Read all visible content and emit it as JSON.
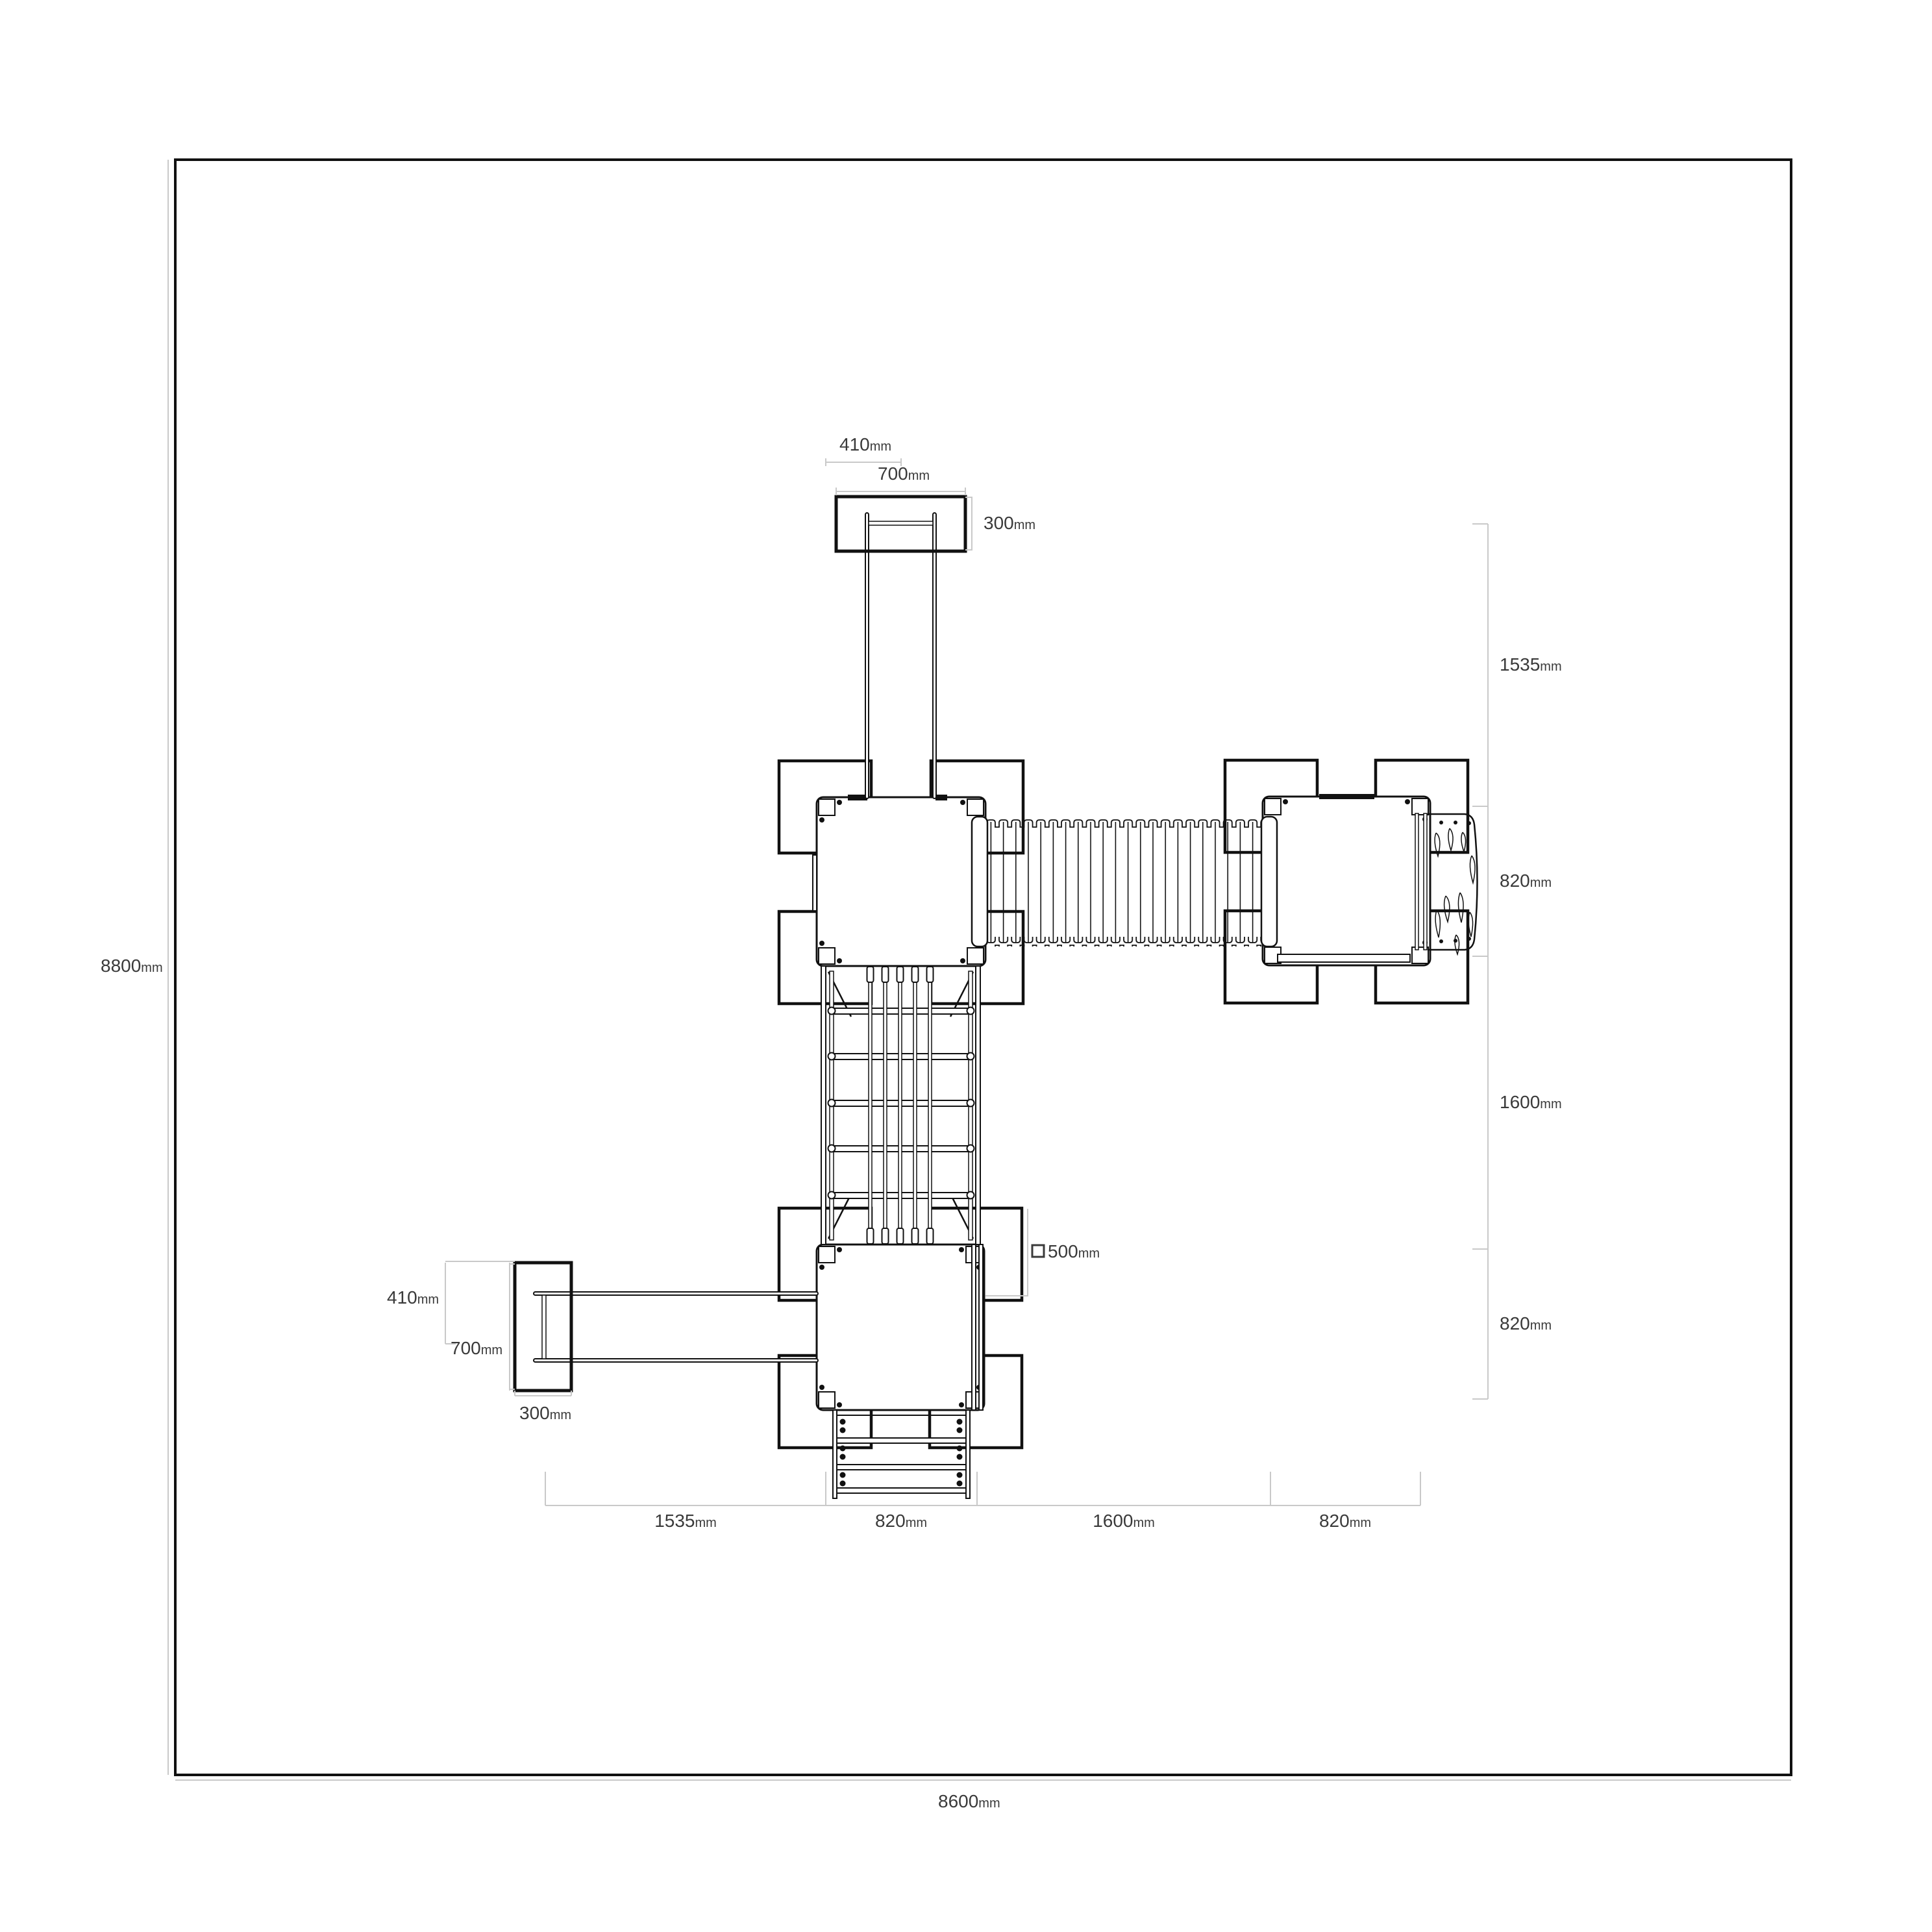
{
  "drawing_type": "playground-structure-plan",
  "colors": {
    "background": "#ffffff",
    "line": "#111111",
    "dimension_line": "#c9c9c9",
    "text": "#3a3a3a"
  },
  "labels": {
    "overall_width": {
      "v": "8600",
      "u": "mm"
    },
    "overall_height": {
      "v": "8800",
      "u": "mm"
    },
    "post_section": {
      "v": "500",
      "u": "mm"
    },
    "top_slide": {
      "offset": {
        "v": "410",
        "u": "mm"
      },
      "length": {
        "v": "700",
        "u": "mm"
      },
      "width": {
        "v": "300",
        "u": "mm"
      }
    },
    "left_slide": {
      "offset": {
        "v": "410",
        "u": "mm"
      },
      "length": {
        "v": "700",
        "u": "mm"
      },
      "width": {
        "v": "300",
        "u": "mm"
      }
    },
    "right_chain": [
      {
        "v": "1535",
        "u": "mm"
      },
      {
        "v": "820",
        "u": "mm"
      },
      {
        "v": "1600",
        "u": "mm"
      },
      {
        "v": "820",
        "u": "mm"
      }
    ],
    "bottom_chain": [
      {
        "v": "1535",
        "u": "mm"
      },
      {
        "v": "820",
        "u": "mm"
      },
      {
        "v": "1600",
        "u": "mm"
      },
      {
        "v": "820",
        "u": "mm"
      }
    ]
  }
}
